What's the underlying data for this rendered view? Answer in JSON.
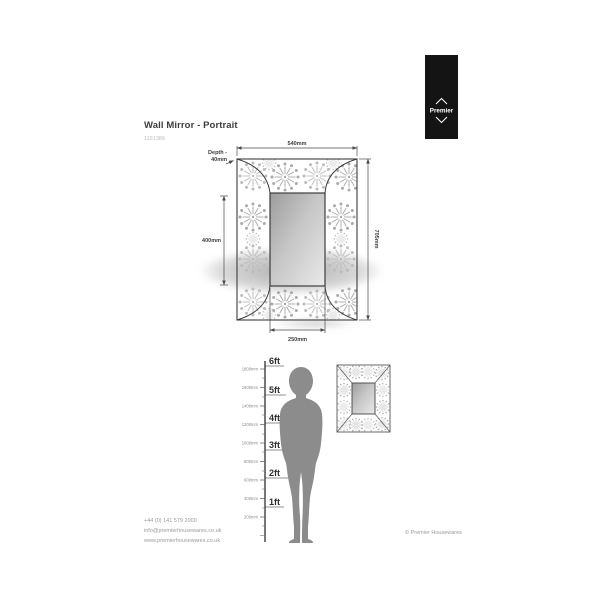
{
  "page": {
    "title": "Wall Mirror - Portrait",
    "product_code": "1101386"
  },
  "logo": {
    "brand": "Premier"
  },
  "diagram": {
    "width": "540mm",
    "height": "705mm",
    "mirror_height": "400mm",
    "mirror_width": "250mm",
    "depth_line1": "Depth -",
    "depth_line2": "40mm"
  },
  "scale": {
    "ft": [
      "6ft",
      "5ft",
      "4ft",
      "3ft",
      "2ft",
      "1ft"
    ],
    "mm": [
      "1800mm",
      "1600mm",
      "1400mm",
      "1200mm",
      "1000mm",
      "800mm",
      "600mm",
      "400mm",
      "200mm"
    ]
  },
  "footer": {
    "phone": "+44 (0) 141 579 2000",
    "email": "info@premierhousewares.co.uk",
    "website": "www.premierhousewares.co.uk",
    "copyright": "© Premier Housewares"
  },
  "colors": {
    "logo_black": "#141414",
    "line": "#4a4a4a",
    "pattern_gray": "#bcbcbc",
    "silhouette_gray": "#8c8c8c"
  }
}
